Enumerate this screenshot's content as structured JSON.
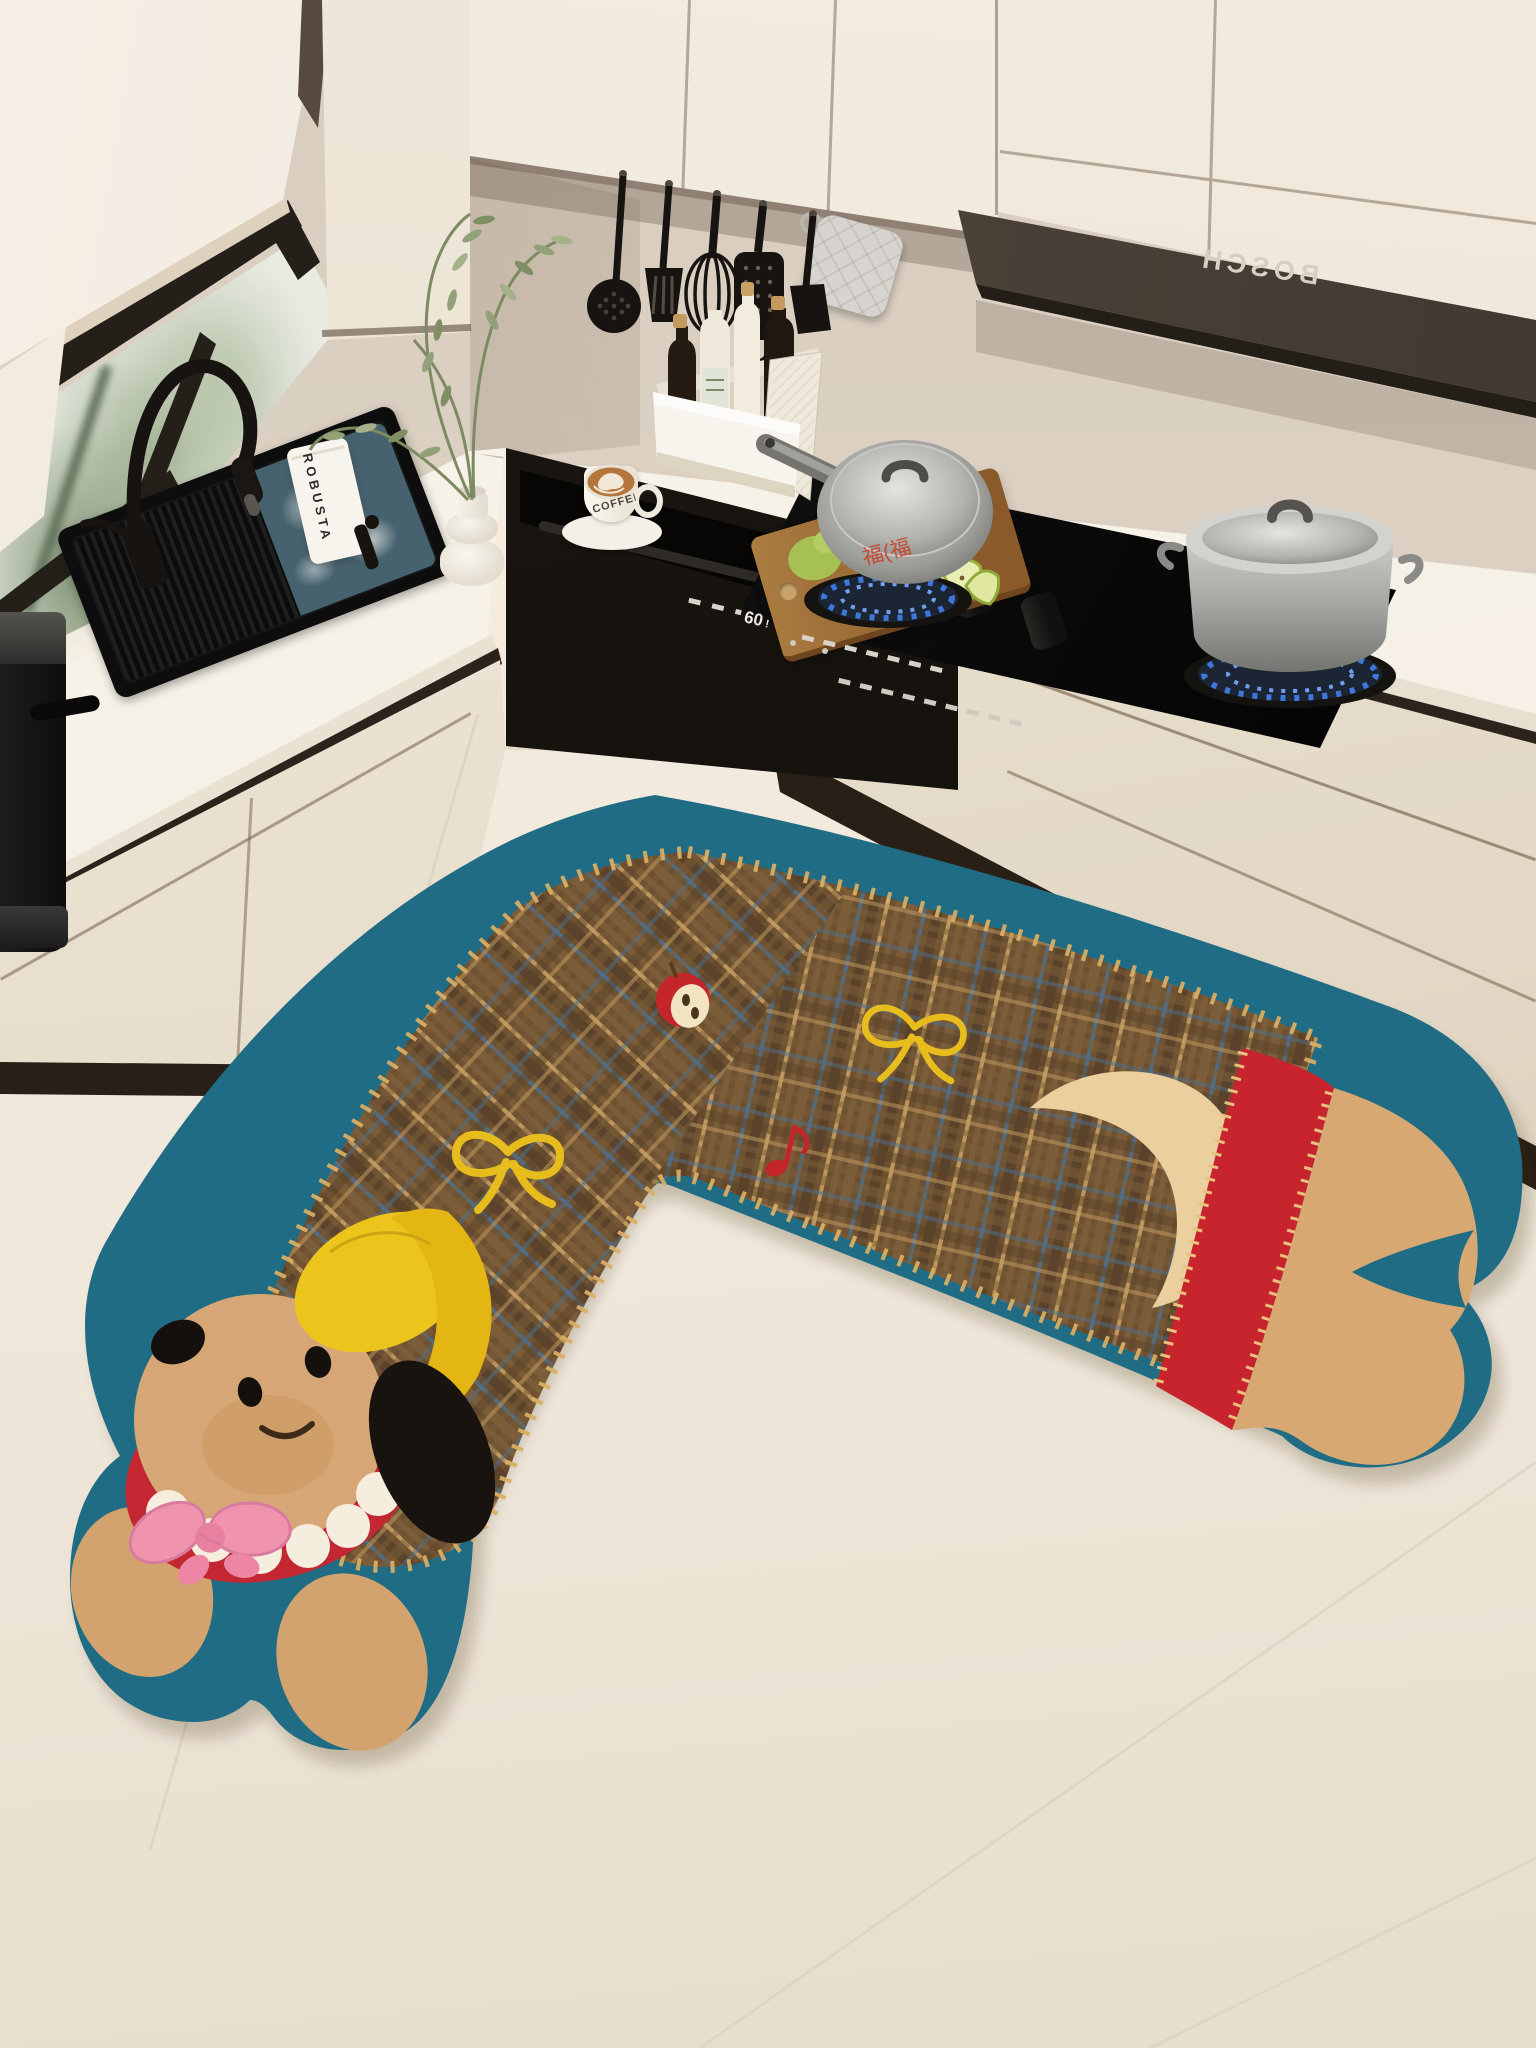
{
  "hood": {
    "brand": "BOSCH"
  },
  "counter_items": {
    "coffee_bag_label": "ROBUSTA",
    "coffee_cup_label": "COFFEE"
  },
  "appliances": {
    "oven_display": "60",
    "oven_alert": "!",
    "flame_color": "#3f78dc"
  },
  "watermark": {
    "text": "福(福"
  },
  "scene": {
    "description": "Bright cream kitchen: corner black sink under a window with roller blind, gas hob with two steel pots over blue flames, built-in black oven, hanging black utensils under cabinets, BOSCH range hood, and an L-shaped cartoon dog floor mat with tartan body and teal border.",
    "objects": [
      "roller-blind",
      "window-greenery",
      "black-faucet",
      "black-sink",
      "olive-branch-vase",
      "coffee-bag",
      "latte-cup",
      "bottle-caddy",
      "oil-bottles",
      "cutting-board",
      "pears",
      "skimmer",
      "slotted-turner",
      "whisk",
      "grater",
      "spatula",
      "pot-holder",
      "range-hood",
      "gas-cooktop",
      "saucepan",
      "stockpot",
      "control-knobs",
      "built-in-oven",
      "drawer-cabinets",
      "espresso-machine",
      "dog-floor-mat"
    ]
  },
  "mat": {
    "style": "cartoon puppy with yellow cap, pink bow, tartan body, paw-shaped ends",
    "motifs": [
      "apple-half",
      "yellow-bow",
      "music-note",
      "yellow-bow",
      "tail-crescent"
    ],
    "colors": {
      "border_teal": "#1f6c84",
      "plaid_brown": "#6d5131",
      "plaid_blue": "#4e708c",
      "plaid_tan": "#c59e62",
      "head_tan": "#d5a372",
      "cap_yellow": "#e9c31b",
      "collar_red": "#c3262e",
      "bow_pink": "#ee92ac"
    }
  }
}
